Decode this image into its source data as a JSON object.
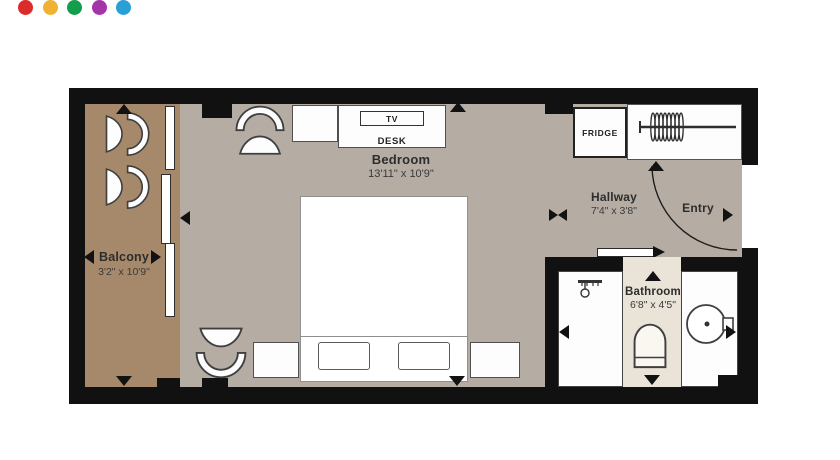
{
  "dots": [
    {
      "name": "red",
      "color": "#dc2b2b"
    },
    {
      "name": "yellow",
      "color": "#efb232"
    },
    {
      "name": "green",
      "color": "#129e4a"
    },
    {
      "name": "purple",
      "color": "#a335a9"
    },
    {
      "name": "blue",
      "color": "#29a0d5"
    }
  ],
  "floorplan": {
    "balcony": {
      "label": "Balcony",
      "dimensions": "3'2\" x 10'9\""
    },
    "bedroom": {
      "label": "Bedroom",
      "dimensions": "13'11\" x 10'9\""
    },
    "hallway": {
      "label": "Hallway",
      "dimensions": "7'4\" x 3'8\""
    },
    "entry": {
      "label": "Entry"
    },
    "bathroom": {
      "label": "Bathroom",
      "dimensions": "6'8\" x 4'5\""
    },
    "fixtures": {
      "tv": "TV",
      "desk": "DESK",
      "fridge": "FRIDGE"
    }
  },
  "colors": {
    "wall": "#111111",
    "balcony_floor": "#a6896b",
    "room_floor": "#b5ada4",
    "bath_niche": "#e9e3d8"
  }
}
